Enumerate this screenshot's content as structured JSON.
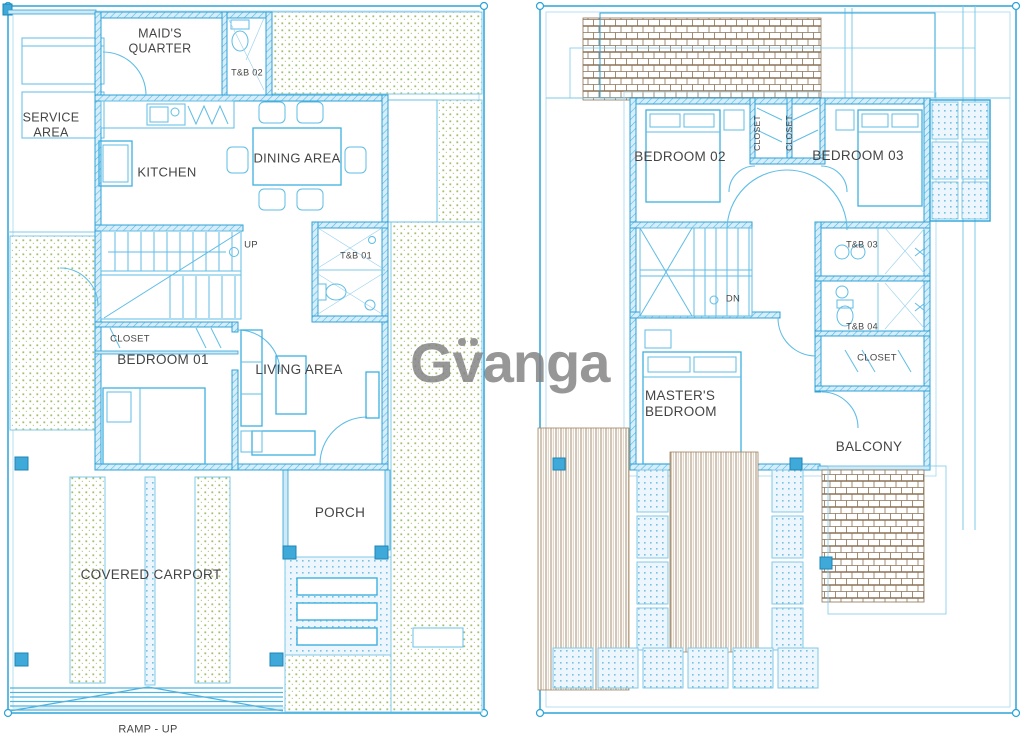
{
  "watermark": {
    "text": "Gvanga",
    "color": "#8c8c8c"
  },
  "palette": {
    "line_blue": "#2ba3d8",
    "text_gray": "#454545",
    "lawn_green": "#a3bf6d",
    "roof_brown": "#8a7156",
    "wall_fill": "#d7edf9"
  },
  "ground_floor": {
    "labels": {
      "service_area": "SERVICE AREA",
      "maids_quarter": "MAID'S QUARTER",
      "tb02": "T&B 02",
      "kitchen": "KITCHEN",
      "dining_area": "DINING AREA",
      "up": "UP",
      "tb01": "T&B 01",
      "closet": "CLOSET",
      "bedroom01": "BEDROOM 01",
      "living_area": "LIVING AREA",
      "porch": "PORCH",
      "covered_carport": "COVERED CARPORT",
      "ramp": "RAMP - UP"
    }
  },
  "second_floor": {
    "labels": {
      "bedroom02": "BEDROOM 02",
      "closet_a": "CLOSET",
      "closet_b": "CLOSET",
      "bedroom03": "BEDROOM 03",
      "tb03": "T&B 03",
      "dn": "DN",
      "tb04": "T&B 04",
      "closet_c": "CLOSET",
      "masters_bedroom": "MASTER'S BEDROOM",
      "balcony": "BALCONY"
    }
  }
}
